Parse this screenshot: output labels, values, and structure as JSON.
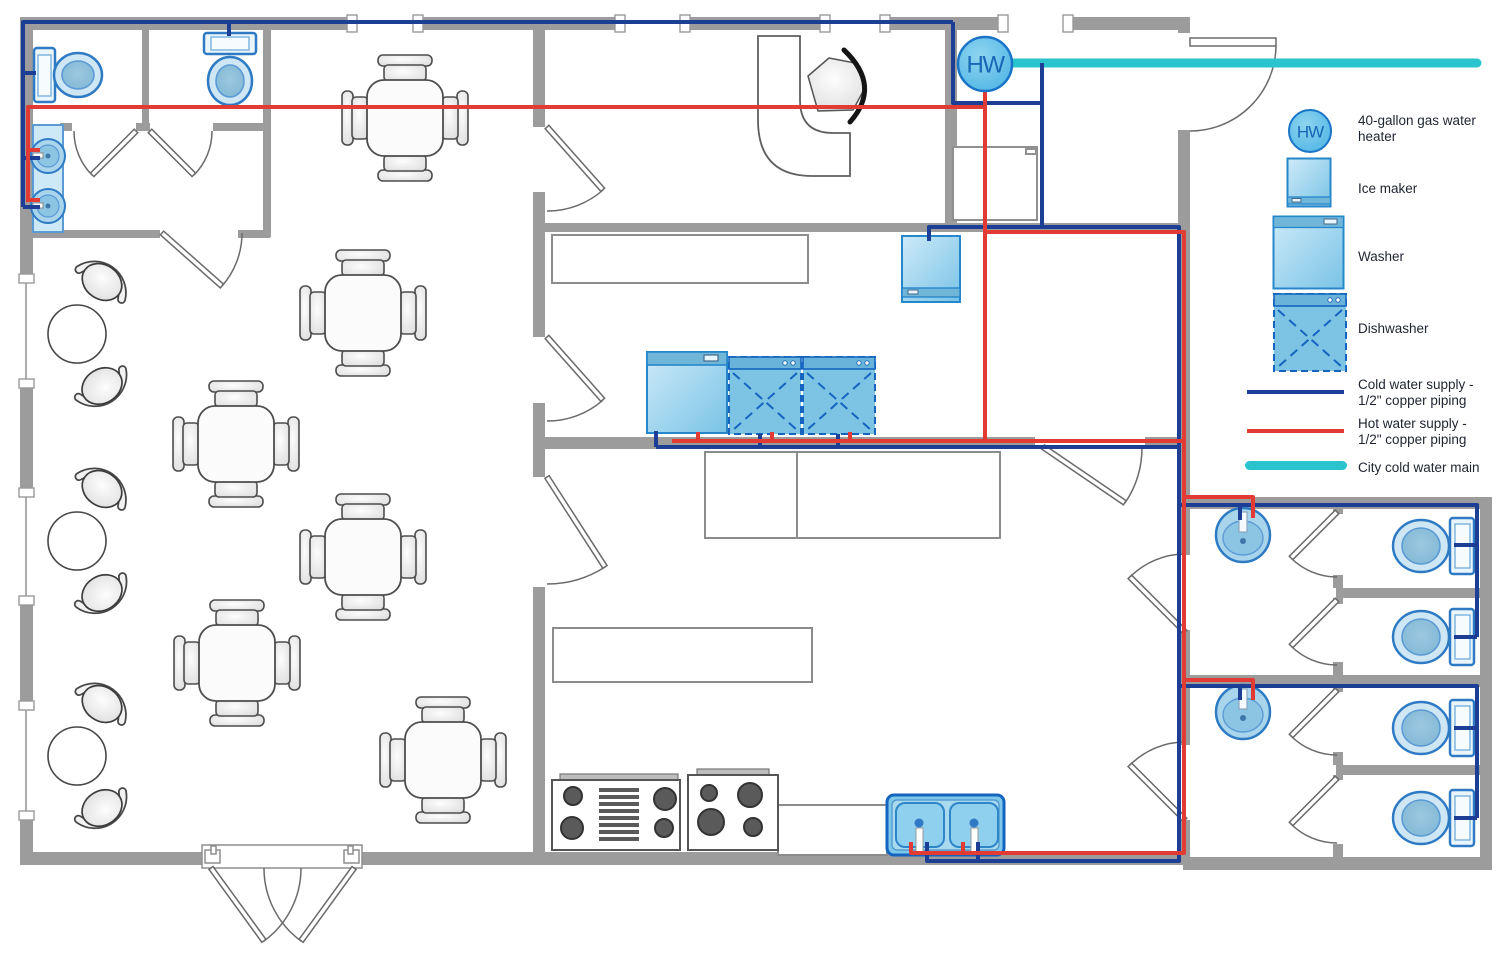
{
  "labels": {
    "water_heater_abbr": "HW"
  },
  "legend": {
    "items": [
      {
        "id": "water-heater",
        "label": "40-gallon gas water\nheater"
      },
      {
        "id": "ice-maker",
        "label": "Ice maker"
      },
      {
        "id": "washer",
        "label": "Washer"
      },
      {
        "id": "dishwasher",
        "label": "Dishwasher"
      },
      {
        "id": "cold-water",
        "label": "Cold water supply -\n1/2\" copper piping"
      },
      {
        "id": "hot-water",
        "label": "Hot water supply -\n1/2\" copper piping"
      },
      {
        "id": "city-main",
        "label": "City cold water main"
      }
    ]
  },
  "colors": {
    "cold_water": "#1c3e94",
    "hot_water": "#e23b33",
    "city_main": "#29c4ce",
    "wall": "#9c9c9c",
    "fixture_stroke": "#2e7bc4",
    "appliance_fill": "#7ec9ea"
  },
  "plan": {
    "fixtures": {
      "gas_water_heater": 1,
      "ice_maker": 1,
      "washer": 1,
      "dishwashers": 2,
      "refrigerator": 1,
      "ranges": 2,
      "kitchen_double_sink": 1,
      "restroom_sinks": 4,
      "toilets": 6
    },
    "furniture": {
      "four_seat_square_tables": 6,
      "two_seat_round_tables": 3,
      "reception_desk": 1,
      "chairs": 31
    }
  }
}
